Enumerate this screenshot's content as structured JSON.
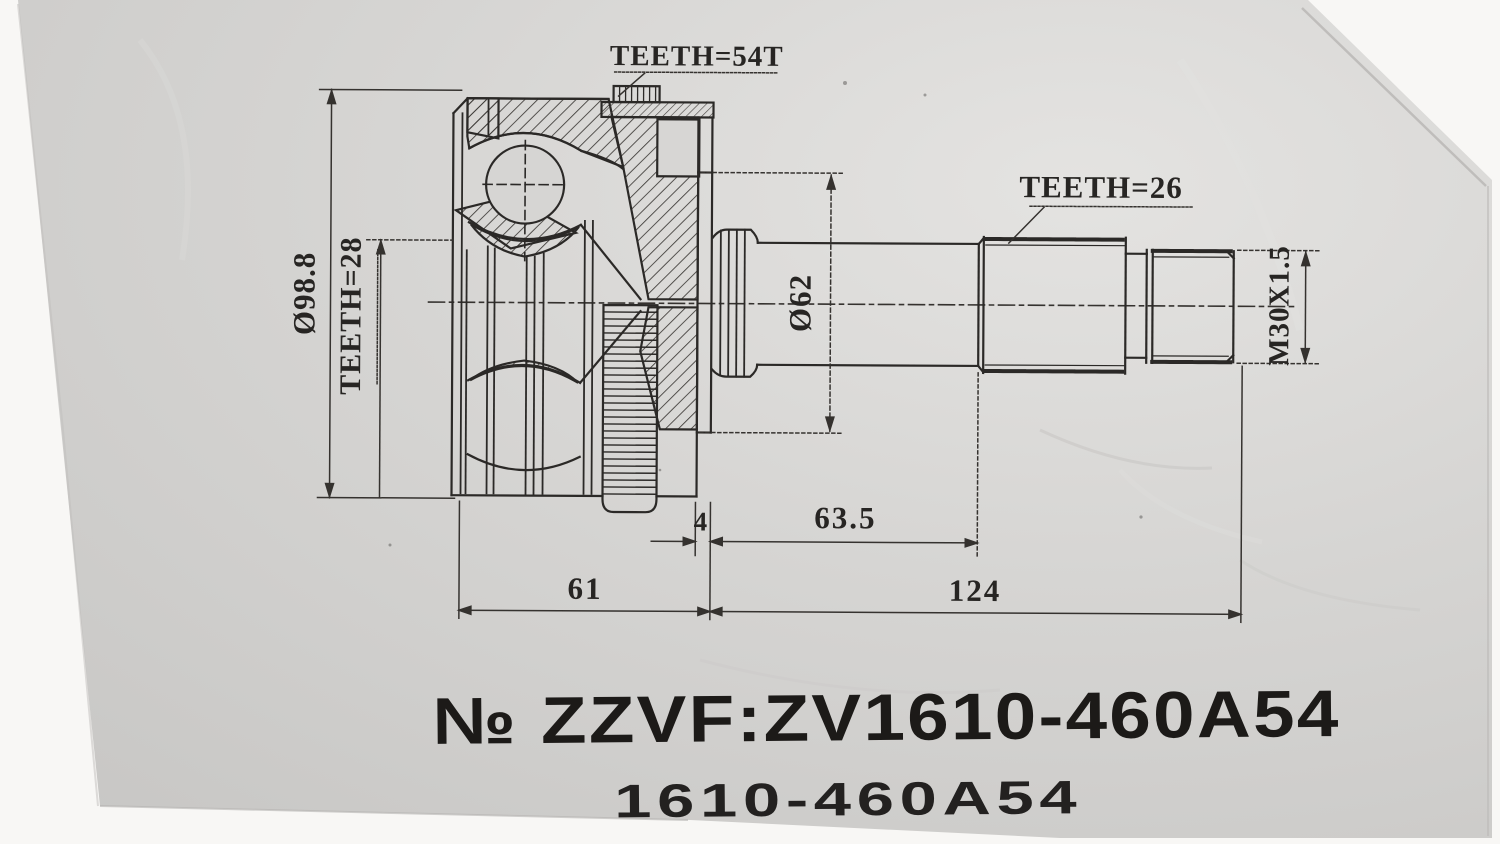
{
  "stamp": {
    "line1": "№ ZZVF:ZV1610-460A54",
    "line2": "1610-460A54"
  },
  "annotations": {
    "abs_ring_teeth": "TEETH=54T",
    "outer_spline_teeth": "TEETH=26",
    "inner_spline_teeth": "TEETH=28",
    "outer_diameter": "Ø98.8",
    "flange_diameter": "Ø62",
    "thread_spec": "M30X1.5"
  },
  "dimensions_mm": {
    "flange_width": "4",
    "shaft_plain_length": "63.5",
    "joint_body_length": "61",
    "shaft_length": "124"
  },
  "colors": {
    "paper": "#d6d5d3",
    "ink": "#2b2927",
    "background": "#f7f6f4"
  }
}
